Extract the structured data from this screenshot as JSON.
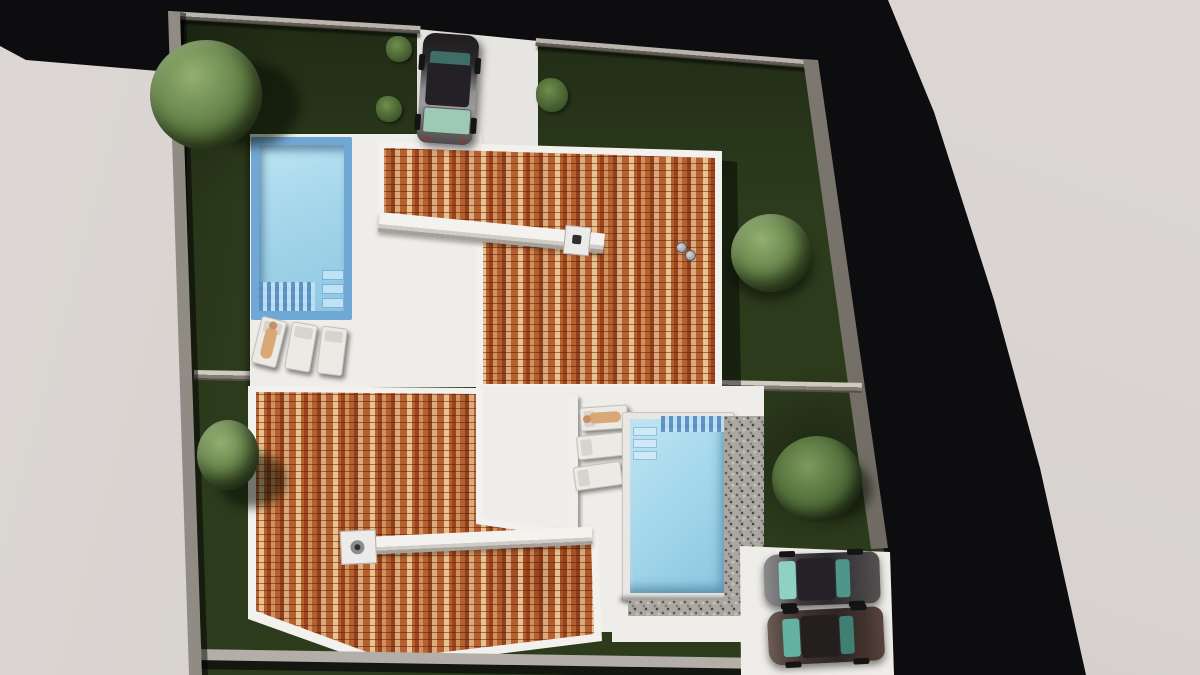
{
  "scene": {
    "description": "Top-down aerial 3D architectural rendering of a walled plot split into two lots, each with a villa with mottled terracotta tile roof, white terrace, private swimming pool, sun loungers and dark lawn; one car on the upper driveway and two cars in the lower-right parking; neighbouring light-grey flat roof on the left and dark asphalt around the plot",
    "counts": {
      "houses": 2,
      "pools": 2,
      "cars": 3,
      "sun_loungers": 6,
      "people_on_loungers": 2,
      "trees": 3,
      "shrubs": 3,
      "bushes": 1,
      "chimneys": 2
    }
  },
  "palette": {
    "bg_black": "#0d0c0e",
    "offplot_gray": "#d8d3d1",
    "building_gray": "#d5d0cc",
    "lawn_green": "#2c3b1c",
    "terrace_white": "#efede9",
    "driveway_white": "#e7e5e1",
    "wall_gray": "#908c84",
    "wall_cap": "#b9b5ad",
    "roof_base": "#b5602f",
    "fascia_white": "#f3f1ee",
    "pool_water": "#a6d7eb",
    "pool_border": "#6fa8d4",
    "pool_coping": "#e9e7e3",
    "gravel_gray": "#aba8a2",
    "tree_green": "#6d8a50",
    "bush_green": "#55713d",
    "sidewalk_gray": "#b3afa8",
    "car_dark": "#39373a",
    "car_silver": "#8f8e90",
    "car_glass": "#8fd2c4",
    "car_maroon": "#4a3a34",
    "person_tan": "#d9a877"
  }
}
